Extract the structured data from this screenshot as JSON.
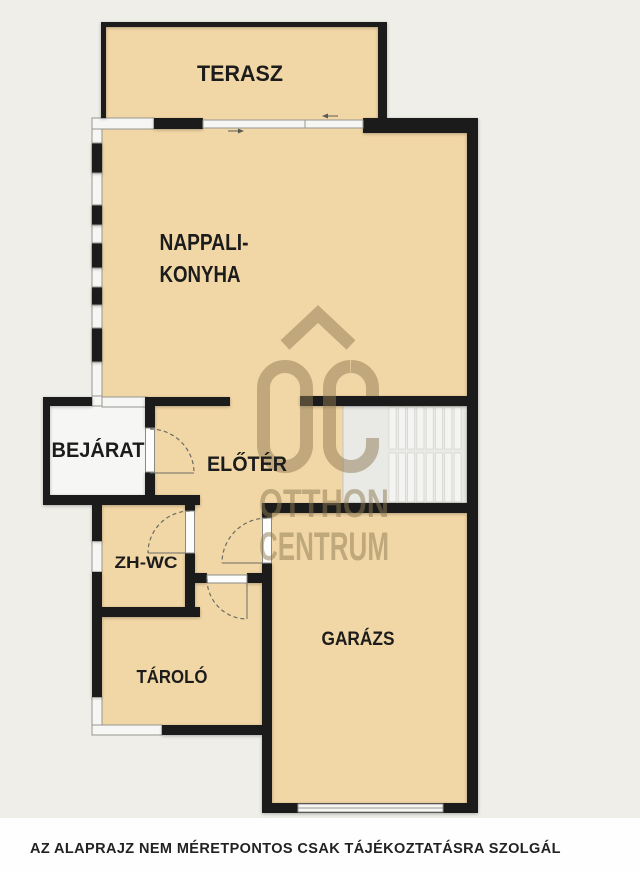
{
  "rooms": {
    "terasz": {
      "label": "TERASZ"
    },
    "nappali_konyha": {
      "label_line1": "NAPPALI-",
      "label_line2": "KONYHA"
    },
    "bejarat": {
      "label": "BEJÁRAT"
    },
    "eloter": {
      "label": "ELŐTÉR"
    },
    "zh_wc": {
      "label": "ZH-WC"
    },
    "tarolo": {
      "label": "TÁROLÓ"
    },
    "garazs": {
      "label": "GARÁZS"
    }
  },
  "watermark": {
    "line1": "OTTHON",
    "line2": "CENTRUM"
  },
  "disclaimer": "AZ ALAPRAJZ NEM MÉRETPONTOS CSAK TÁJÉKOZTATÁSRA SZOLGÁL",
  "colors": {
    "page_background": "#fefefe",
    "plan_background": "#efeee9",
    "room_fill": "#f2d7a6",
    "wall": "#1b1b1b",
    "window": "#f6f6f4",
    "watermark": "#8d7a52"
  }
}
